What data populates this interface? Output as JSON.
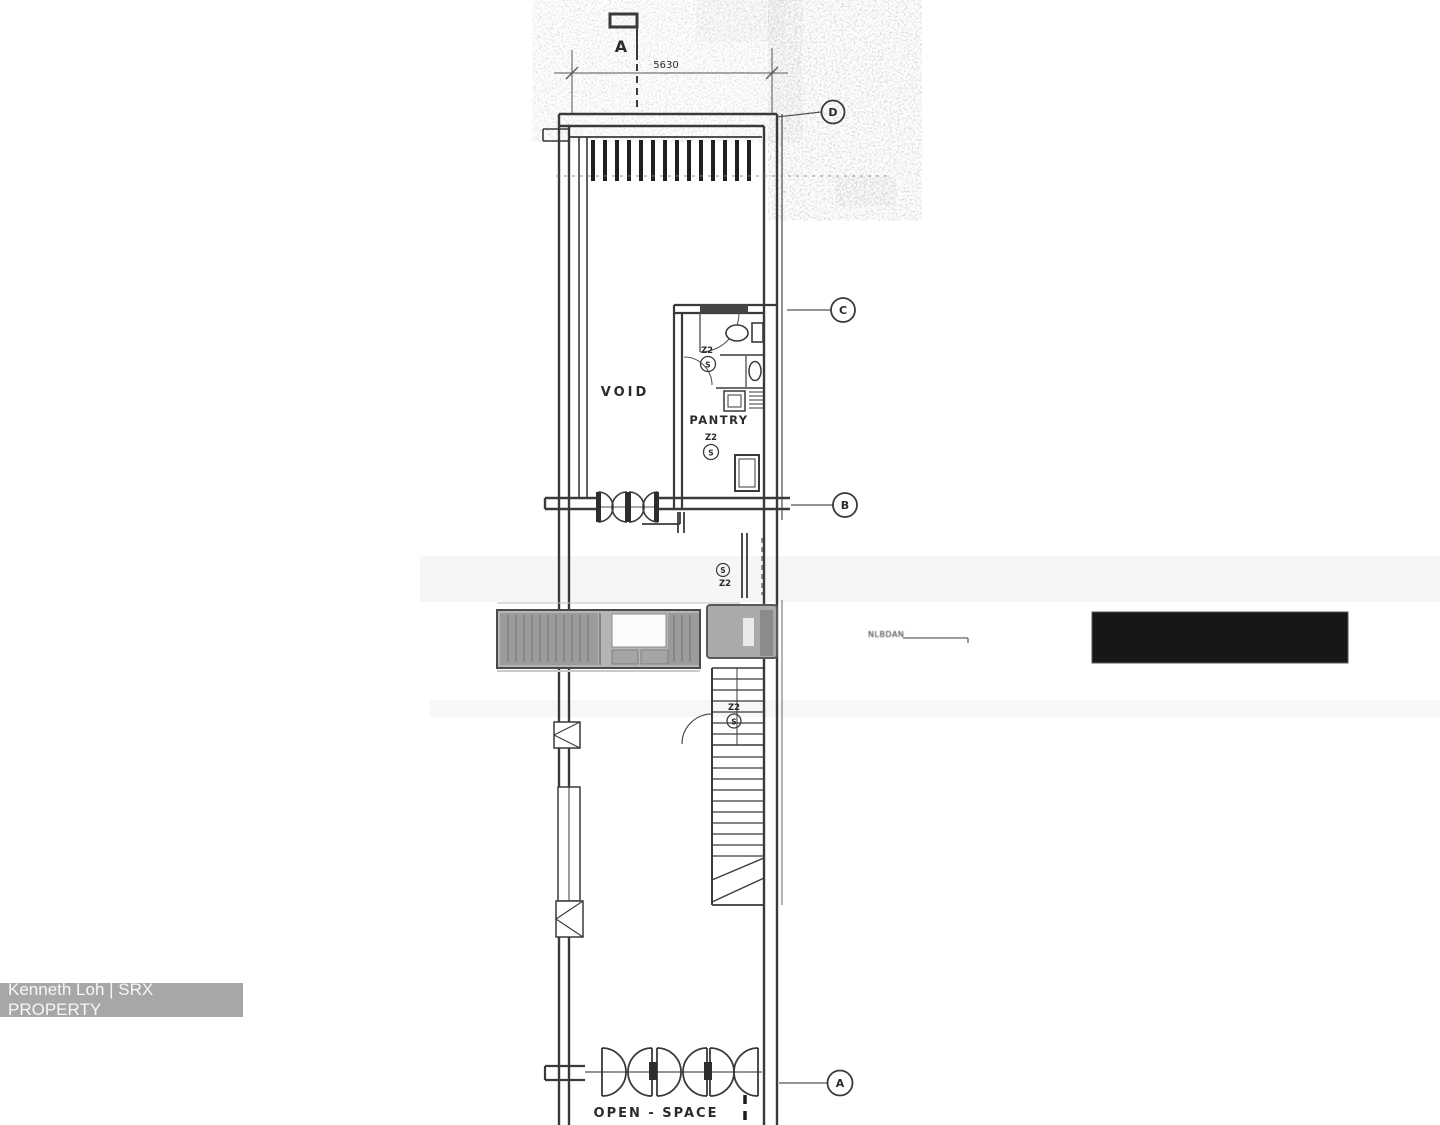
{
  "plan": {
    "section_marker": "A",
    "dimension": "5630",
    "grid_bubbles": {
      "d": "D",
      "c": "C",
      "b": "B",
      "a": "A"
    },
    "room_labels": {
      "void": "VOID",
      "pantry": "PANTRY",
      "open_space": "OPEN - SPACE"
    },
    "fixture_labels": {
      "zone": "Z2",
      "switch": "S"
    },
    "small_annotation": "NLBDAN"
  },
  "watermark": {
    "text": "Kenneth Loh | SRX PROPERTY",
    "bg_color": "#a7a7a7",
    "text_color": "#f7f7f7"
  },
  "redaction": {
    "color": "#171717"
  },
  "colors": {
    "ink": "#3a3a3a",
    "paper": "#ffffff"
  }
}
